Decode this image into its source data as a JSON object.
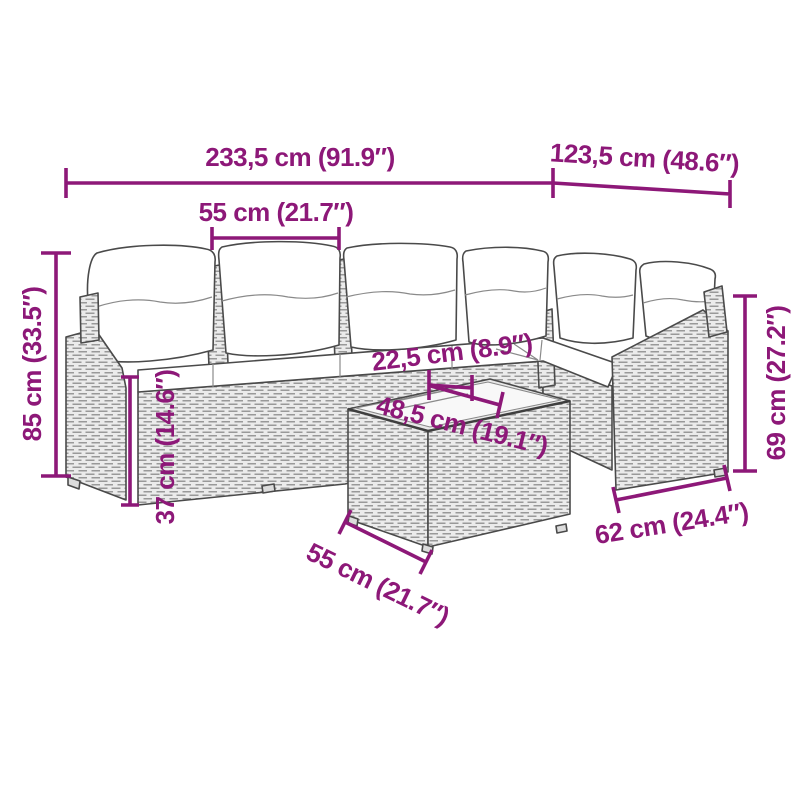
{
  "figure": {
    "kind": "product-dimension-diagram",
    "subject": "poly rattan garden lounge set with cushions and coffee table",
    "accent_color": "#8d1878",
    "rattan_color": "#ebebeb",
    "cushion_color": "#ffffff"
  },
  "dimensions": {
    "overall_width": "233,5 cm (91.9″)",
    "corner_depth": "123,5 cm (48.6″)",
    "seat_module_width": "55 cm (21.7″)",
    "overall_height": "85 cm (33.5″)",
    "seat_height": "37 cm (14.6″)",
    "table_gap": "22,5 cm (8.9″)",
    "tabletop_width": "48,5 cm (19.1″)",
    "table_depth": "55 cm (21.7″)",
    "backrest_height": "69 cm (27.2″)",
    "module_depth": "62 cm (24.4″)"
  }
}
